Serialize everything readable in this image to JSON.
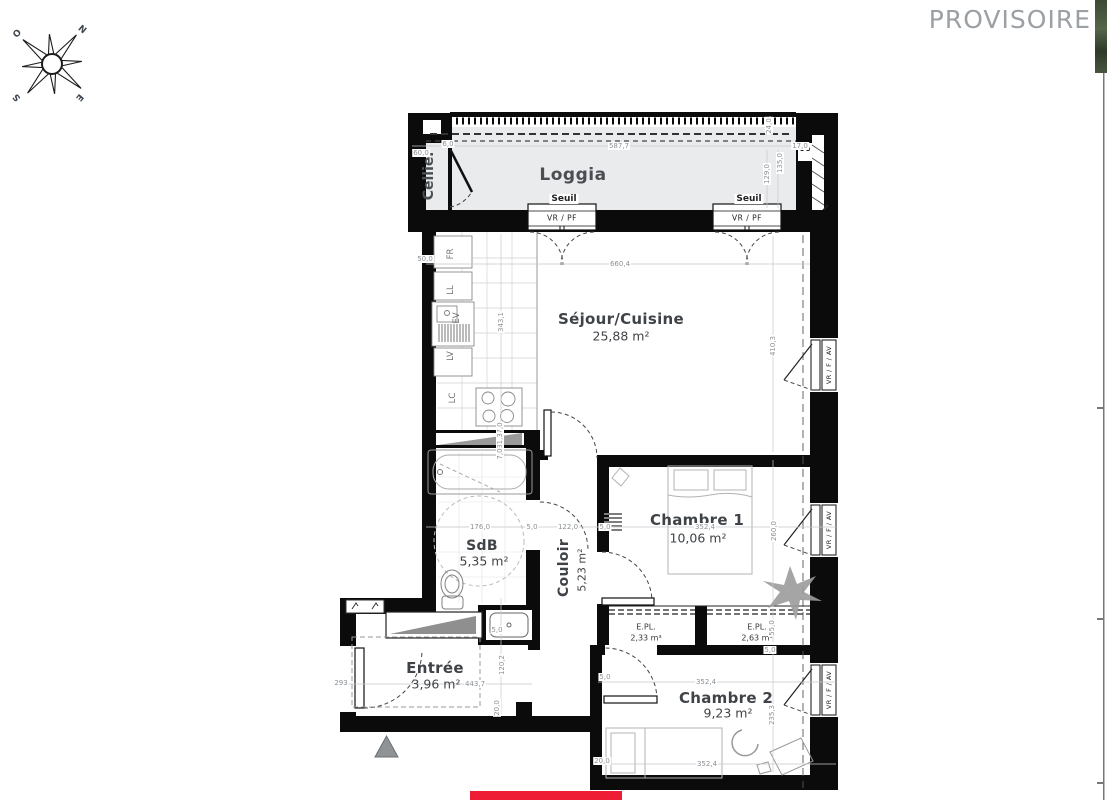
{
  "watermark": "PROVISOIRE",
  "compass": {
    "west": "O",
    "north": "N",
    "south": "S",
    "east": "E"
  },
  "rooms": {
    "cellier": {
      "name": "Cellier"
    },
    "loggia": {
      "name": "Loggia"
    },
    "sejour_cuisine": {
      "name": "Séjour/Cuisine",
      "area": "25,88 m²"
    },
    "sdb": {
      "name": "SdB",
      "area": "5,35 m²"
    },
    "couloir": {
      "name": "Couloir",
      "area": "5,23 m²"
    },
    "chambre1": {
      "name": "Chambre 1",
      "area": "10,06 m²"
    },
    "chambre2": {
      "name": "Chambre 2",
      "area": "9,23 m²"
    },
    "entree": {
      "name": "Entrée",
      "area": "3,96 m²"
    },
    "placard_left": {
      "name": "E.PL.",
      "area": "2,33 m³"
    },
    "placard_right": {
      "name": "E.PL.",
      "area": "2,63 m³"
    }
  },
  "openings": {
    "seuil": "Seuil",
    "vr_pf": "VR / PF",
    "vr_f_av": "VR / F / AV"
  },
  "kitchen_labels": [
    "FR",
    "LL",
    "EV",
    "LV",
    "LC"
  ],
  "dimensions": [
    {
      "t": "60,0",
      "x": 421,
      "y": 153,
      "r": 0
    },
    {
      "t": "6,0",
      "x": 448,
      "y": 144,
      "r": 0
    },
    {
      "t": "587,7",
      "x": 619,
      "y": 146,
      "r": 0
    },
    {
      "t": "17,0",
      "x": 800,
      "y": 146,
      "r": 0
    },
    {
      "t": "24,0",
      "x": 769,
      "y": 126,
      "r": 1
    },
    {
      "t": "135,0",
      "x": 780,
      "y": 163,
      "r": 1
    },
    {
      "t": "129,0",
      "x": 767,
      "y": 174,
      "r": 1
    },
    {
      "t": "660,4",
      "x": 620,
      "y": 264,
      "r": 0
    },
    {
      "t": "50,0",
      "x": 425,
      "y": 259,
      "r": 0
    },
    {
      "t": "343,1",
      "x": 501,
      "y": 322,
      "r": 1
    },
    {
      "t": "410,3",
      "x": 773,
      "y": 346,
      "r": 1
    },
    {
      "t": "7,0",
      "x": 500,
      "y": 428,
      "r": 1
    },
    {
      "t": "31,3",
      "x": 500,
      "y": 441,
      "r": 1
    },
    {
      "t": "7,0",
      "x": 500,
      "y": 454,
      "r": 1
    },
    {
      "t": "176,0",
      "x": 480,
      "y": 527,
      "r": 0
    },
    {
      "t": "5,0",
      "x": 532,
      "y": 527,
      "r": 0
    },
    {
      "t": "122,0",
      "x": 568,
      "y": 527,
      "r": 0
    },
    {
      "t": "5,0",
      "x": 605,
      "y": 527,
      "r": 0
    },
    {
      "t": "352,4",
      "x": 705,
      "y": 527,
      "r": 0
    },
    {
      "t": "260,0",
      "x": 774,
      "y": 531,
      "r": 1
    },
    {
      "t": "5,0",
      "x": 497,
      "y": 630,
      "r": 0
    },
    {
      "t": "55,0",
      "x": 772,
      "y": 628,
      "r": 1
    },
    {
      "t": "5,0",
      "x": 770,
      "y": 650,
      "r": 0
    },
    {
      "t": "120,2",
      "x": 502,
      "y": 665,
      "r": 1
    },
    {
      "t": "5,0",
      "x": 605,
      "y": 677,
      "r": 0
    },
    {
      "t": "443,7",
      "x": 475,
      "y": 684,
      "r": 0
    },
    {
      "t": "293",
      "x": 341,
      "y": 683,
      "r": 0
    },
    {
      "t": "352,4",
      "x": 706,
      "y": 682,
      "r": 0
    },
    {
      "t": "20,0",
      "x": 497,
      "y": 708,
      "r": 1
    },
    {
      "t": "235,3",
      "x": 772,
      "y": 715,
      "r": 1
    },
    {
      "t": "20,0",
      "x": 602,
      "y": 761,
      "r": 0
    },
    {
      "t": "352,4",
      "x": 707,
      "y": 764,
      "r": 0
    }
  ],
  "colors": {
    "wall": "#0b0b0b",
    "loggia_floor": "#eaebec",
    "accent_red": "#ee1c35",
    "watermark": "#9ba0a5",
    "dim_text": "#8b9196"
  }
}
